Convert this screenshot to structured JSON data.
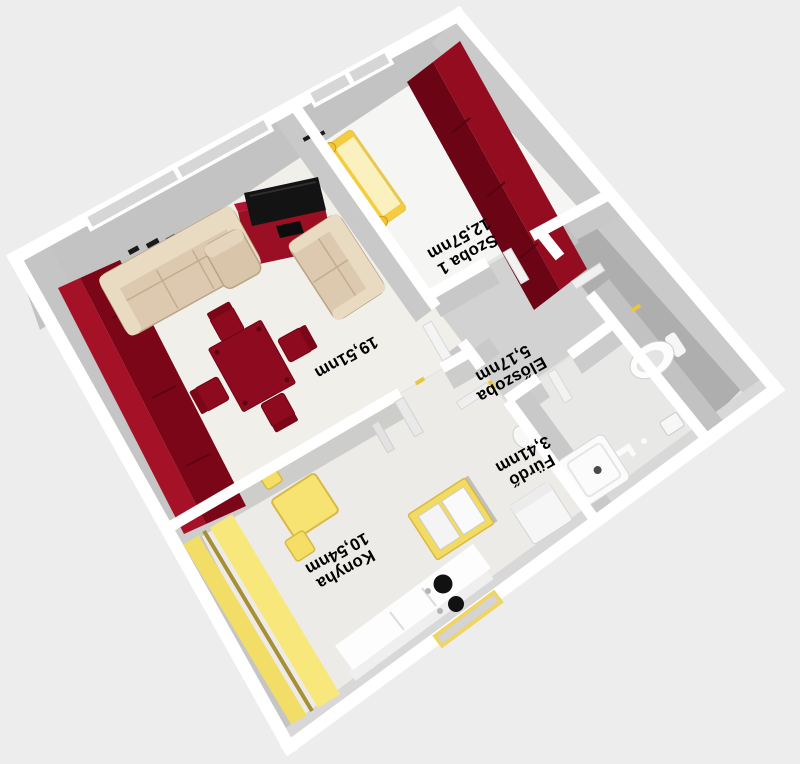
{
  "view": {
    "type": "3d-floorplan-aerial-view",
    "orientation": "plan rotated, labels appear upside-down"
  },
  "rooms": {
    "living": {
      "area": "19,51nm"
    },
    "szoba1": {
      "name": "Szoba 1",
      "area": "12,57nm"
    },
    "eloszoba": {
      "name": "Előszoba",
      "area": "5,17nm"
    },
    "furdo": {
      "name": "Fürdő",
      "area": "3,41nm"
    },
    "konyha": {
      "name": "Konyha",
      "area": "10,54nm"
    }
  },
  "colors": {
    "background": "#EDEDED",
    "wall_top": "#FFFFFF",
    "wall_face": "#C8C8C8",
    "floor_light": "#F0EFEA",
    "floor_hall": "#D2D2D2",
    "floor_wc": "#AEAEAE",
    "furniture_red": "#8E0A1E",
    "furniture_red_dark": "#6B0414",
    "furniture_yellow": "#F6E372",
    "furniture_tan": "#DCC9AF",
    "tv_black": "#131313",
    "label_text": "#000000"
  }
}
